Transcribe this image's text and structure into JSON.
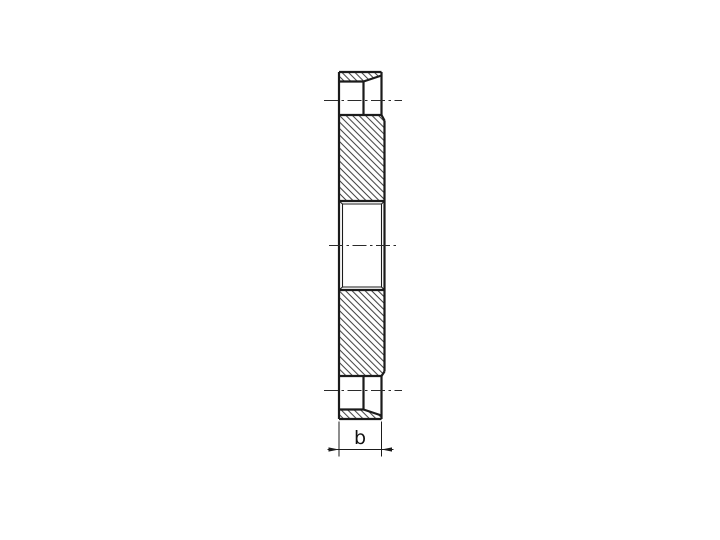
{
  "colors": {
    "background": "#ffffff",
    "line": "#1b1b1b",
    "centerline": "#2b2b2b",
    "text": "#111111"
  },
  "style": {
    "contour_width": 2.2,
    "fine_width": 1.1,
    "centerline_width": 0.9,
    "dimension_width": 1.0,
    "hatch_spacing": 4.6,
    "hatch_angle": -45,
    "hatch_stroke_width": 0.85,
    "centerline_dash": "14 3.5 2.5 3.5"
  },
  "drawing": {
    "description": "Side cross-section of a circular flange: hatched sectioned ring, central bore with chamfered ends, bolt holes at top and bottom, thickness dimension b",
    "hatched_regions": [
      {
        "name": "top-bolt-boss-hatch",
        "points": "339,72 381.5,72 381.5,75.5 363.5,81.5 339,81.5"
      },
      {
        "name": "upper-flange-body-hatch",
        "points": "339,115 381.5,115 384.5,120.5 384.5,201 339,201"
      },
      {
        "name": "lower-flange-body-hatch",
        "points": "339,290 384.5,290 384.5,371.5 381.5,376 339,376"
      },
      {
        "name": "bottom-bolt-boss-hatch",
        "points": "339,409.5 363.5,409.5 381.5,415.5 381.5,419 339,419"
      }
    ],
    "contour_lines": [
      {
        "name": "outer-top-edge",
        "x1": 339,
        "y1": 72,
        "x2": 381.5,
        "y2": 72
      },
      {
        "name": "left-face-edge",
        "x1": 339,
        "y1": 72,
        "x2": 339,
        "y2": 419
      },
      {
        "name": "top-boss-right-edge",
        "x1": 381.5,
        "y1": 72,
        "x2": 381.5,
        "y2": 115
      },
      {
        "name": "top-bolt-hole-edge",
        "x1": 339,
        "y1": 81.5,
        "x2": 363.5,
        "y2": 81.5
      },
      {
        "name": "top-bolt-hole-slant",
        "x1": 363.5,
        "y1": 81.5,
        "x2": 381.5,
        "y2": 75.5
      },
      {
        "name": "top-bolt-hole-inner-vertical",
        "x1": 363.5,
        "y1": 81.5,
        "x2": 363.5,
        "y2": 115
      },
      {
        "name": "body-top-edge",
        "x1": 339,
        "y1": 115,
        "x2": 381.5,
        "y2": 115
      },
      {
        "name": "body-top-right-chamfer",
        "x1": 381.5,
        "y1": 115,
        "x2": 384.5,
        "y2": 120.5
      },
      {
        "name": "body-right-edge",
        "x1": 384.5,
        "y1": 120.5,
        "x2": 384.5,
        "y2": 371.5
      },
      {
        "name": "bore-top-edge",
        "x1": 339,
        "y1": 201,
        "x2": 384.5,
        "y2": 201
      },
      {
        "name": "bore-bottom-edge",
        "x1": 339,
        "y1": 290,
        "x2": 384.5,
        "y2": 290
      },
      {
        "name": "body-bottom-right-chamfer",
        "x1": 384.5,
        "y1": 371.5,
        "x2": 381.5,
        "y2": 376
      },
      {
        "name": "body-bottom-edge",
        "x1": 339,
        "y1": 376,
        "x2": 381.5,
        "y2": 376
      },
      {
        "name": "bottom-boss-right-edge",
        "x1": 381.5,
        "y1": 376,
        "x2": 381.5,
        "y2": 419
      },
      {
        "name": "bottom-bolt-hole-inner-vertical",
        "x1": 363.5,
        "y1": 376,
        "x2": 363.5,
        "y2": 409.5
      },
      {
        "name": "bottom-bolt-hole-edge",
        "x1": 339,
        "y1": 409.5,
        "x2": 363.5,
        "y2": 409.5
      },
      {
        "name": "bottom-bolt-hole-slant",
        "x1": 363.5,
        "y1": 409.5,
        "x2": 381.5,
        "y2": 415.5
      },
      {
        "name": "outer-bottom-edge",
        "x1": 339,
        "y1": 419,
        "x2": 381.5,
        "y2": 419
      }
    ],
    "fine_lines": [
      {
        "name": "bore-inner-left-vertical",
        "x1": 342.5,
        "y1": 204,
        "x2": 342.5,
        "y2": 287
      },
      {
        "name": "bore-inner-right-vertical",
        "x1": 381.5,
        "y1": 204,
        "x2": 381.5,
        "y2": 287
      },
      {
        "name": "bore-inner-top",
        "x1": 342.5,
        "y1": 204,
        "x2": 381.5,
        "y2": 204
      },
      {
        "name": "bore-inner-bottom",
        "x1": 342.5,
        "y1": 287,
        "x2": 381.5,
        "y2": 287
      },
      {
        "name": "bore-chamfer-top-left",
        "x1": 339,
        "y1": 201,
        "x2": 342.5,
        "y2": 204
      },
      {
        "name": "bore-chamfer-top-right",
        "x1": 384.5,
        "y1": 201,
        "x2": 381.5,
        "y2": 204
      },
      {
        "name": "bore-chamfer-bottom-left",
        "x1": 339,
        "y1": 290,
        "x2": 342.5,
        "y2": 287
      },
      {
        "name": "bore-chamfer-bottom-right",
        "x1": 384.5,
        "y1": 290,
        "x2": 381.5,
        "y2": 287
      }
    ],
    "centerlines": [
      {
        "name": "top-bolt-hole-centerline",
        "x1": 324,
        "y1": 100.5,
        "x2": 402,
        "y2": 100.5
      },
      {
        "name": "main-axis-centerline",
        "x1": 329,
        "y1": 245.5,
        "x2": 398,
        "y2": 245.5
      },
      {
        "name": "bottom-bolt-hole-centerline",
        "x1": 324,
        "y1": 390.5,
        "x2": 402,
        "y2": 390.5
      }
    ],
    "dimension": {
      "label": "b",
      "extension_lines": [
        {
          "name": "dim-extension-left",
          "x1": 339,
          "y1": 421.5,
          "x2": 339,
          "y2": 456.5
        },
        {
          "name": "dim-extension-right",
          "x1": 381.5,
          "y1": 421.5,
          "x2": 381.5,
          "y2": 456.5
        }
      ],
      "line": {
        "name": "dim-line-b",
        "x1": 327.5,
        "y1": 449.5,
        "x2": 393.5,
        "y2": 449.5
      },
      "arrows": [
        {
          "name": "dim-arrow-left",
          "points": "339,449.5 328.5,447.4 328.5,451.6"
        },
        {
          "name": "dim-arrow-right",
          "points": "381.5,449.5 392,447.4 392,451.6"
        }
      ]
    }
  }
}
